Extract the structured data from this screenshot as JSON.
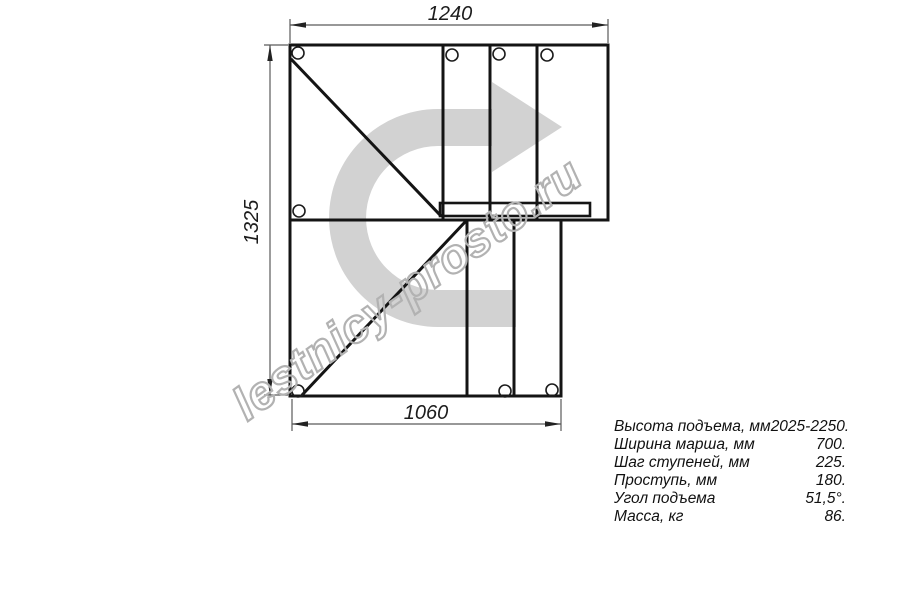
{
  "drawing": {
    "title_semantic": "stair-plan-view",
    "dimensions": {
      "top": "1240",
      "left": "1325",
      "bottom": "1060"
    },
    "watermark": {
      "text": "lestnicy-prosto.ru"
    },
    "icons": {
      "direction_arrow": "u-turn-arrow-icon"
    }
  },
  "specs": {
    "rows": [
      {
        "label": "Высота подъема, мм",
        "value": "2025-2250."
      },
      {
        "label": "Ширина марша, мм",
        "value": "700."
      },
      {
        "label": "Шаг ступеней, мм",
        "value": "225."
      },
      {
        "label": "Проступь, мм",
        "value": "180."
      },
      {
        "label": "Угол подъема",
        "value": "51,5°."
      },
      {
        "label": "Масса, кг",
        "value": "86."
      }
    ]
  },
  "colors": {
    "line": "#141414",
    "dimension_line": "#5a5a5a",
    "arrow_watermark_gray": "#d2d2d2",
    "text_watermark_gray": "#b2b2b2",
    "background": "#ffffff"
  }
}
